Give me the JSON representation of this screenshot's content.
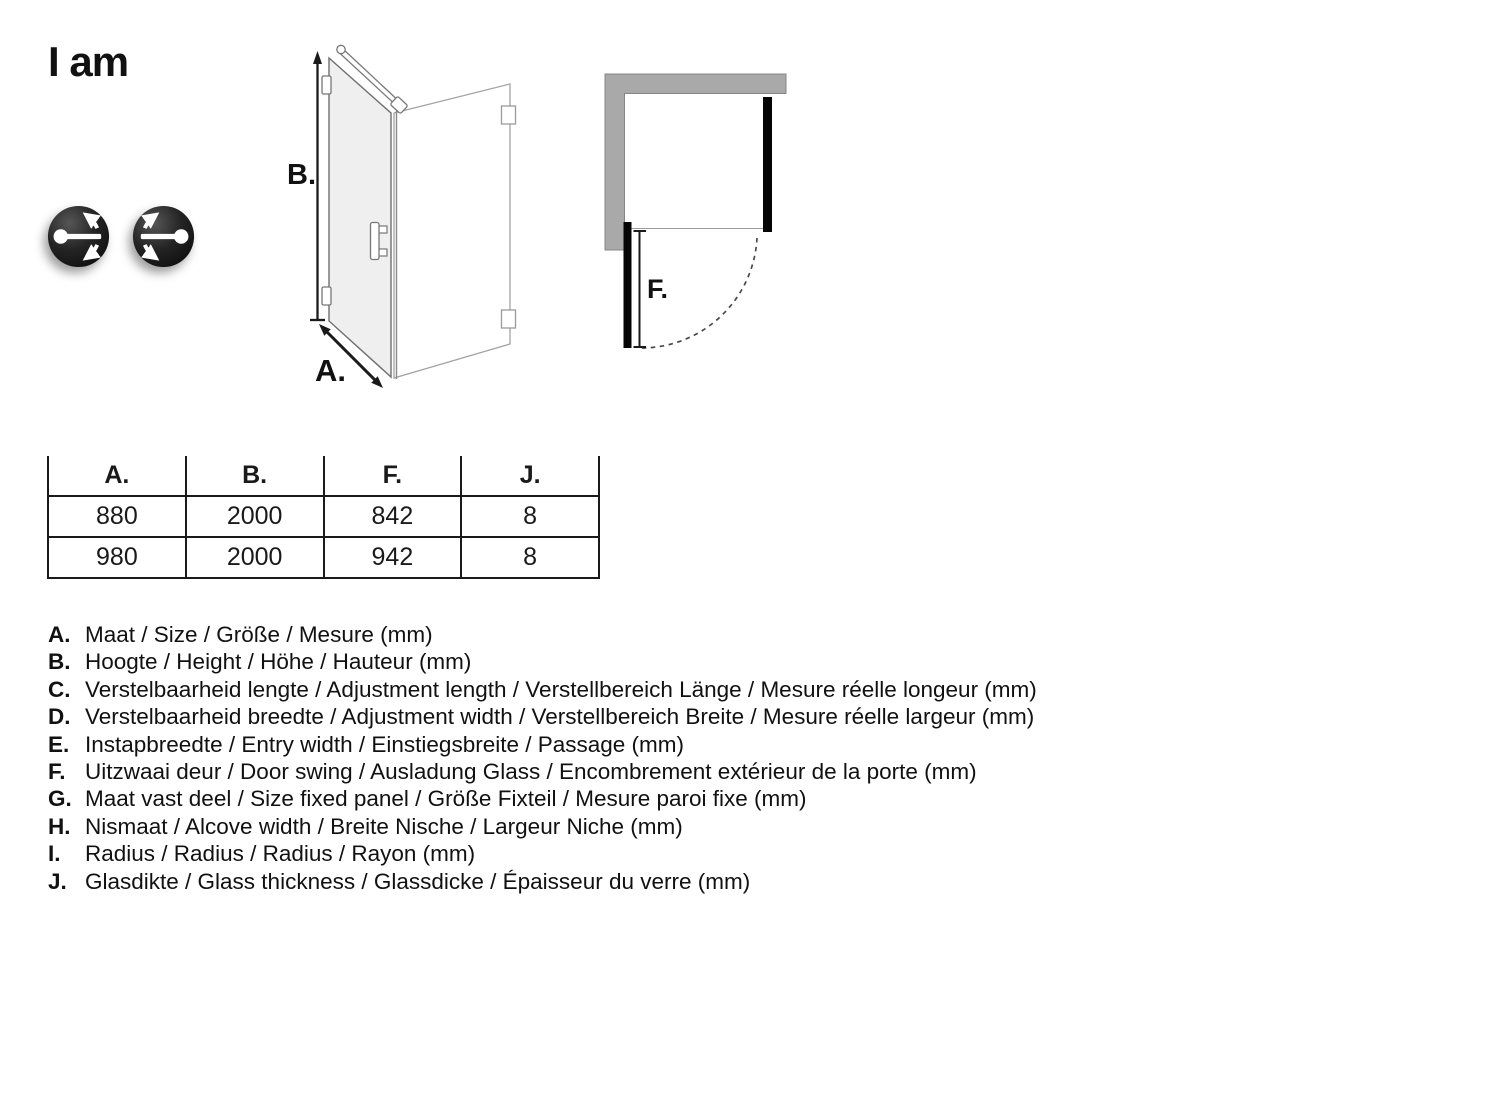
{
  "brand": {
    "logo_text": "I am"
  },
  "icons": {
    "left_icon_name": "door-hinge-left-swing-icon",
    "right_icon_name": "door-hinge-right-swing-icon"
  },
  "diagram_iso": {
    "height_label": "B.",
    "width_label": "A."
  },
  "diagram_top": {
    "door_swing_label": "F."
  },
  "table": {
    "headers": [
      "A.",
      "B.",
      "F.",
      "J."
    ],
    "rows": [
      [
        "880",
        "2000",
        "842",
        "8"
      ],
      [
        "980",
        "2000",
        "942",
        "8"
      ]
    ]
  },
  "legend": {
    "items": [
      {
        "letter": "A.",
        "text": "Maat / Size / Größe / Mesure (mm)"
      },
      {
        "letter": "B.",
        "text": "Hoogte / Height / Höhe / Hauteur (mm)"
      },
      {
        "letter": "C.",
        "text": "Verstelbaarheid lengte / Adjustment length / Verstellbereich Länge / Mesure réelle longeur (mm)"
      },
      {
        "letter": "D.",
        "text": "Verstelbaarheid breedte / Adjustment width / Verstellbereich Breite / Mesure réelle largeur (mm)"
      },
      {
        "letter": "E.",
        "text": "Instapbreedte / Entry width / Einstiegsbreite / Passage (mm)"
      },
      {
        "letter": "F.",
        "text": "Uitzwaai deur / Door swing / Ausladung Glass / Encombrement extérieur de la porte (mm)"
      },
      {
        "letter": "G.",
        "text": "Maat vast deel / Size fixed panel / Größe Fixteil / Mesure paroi fixe (mm)"
      },
      {
        "letter": "H.",
        "text": "Nismaat / Alcove width / Breite Nische / Largeur Niche (mm)"
      },
      {
        "letter": "I.",
        "text": "Radius / Radius / Radius / Rayon (mm)"
      },
      {
        "letter": "J.",
        "text": "Glasdikte / Glass thickness / Glassdicke / Épaisseur du verre (mm)"
      }
    ]
  },
  "colors": {
    "wall_gray": "#a9a9a9",
    "panel_black": "#050505",
    "glass_fill": "#efefef",
    "text": "#1a1a1a",
    "icon_background": "#1c1c1c",
    "icon_glyph": "#ffffff"
  }
}
